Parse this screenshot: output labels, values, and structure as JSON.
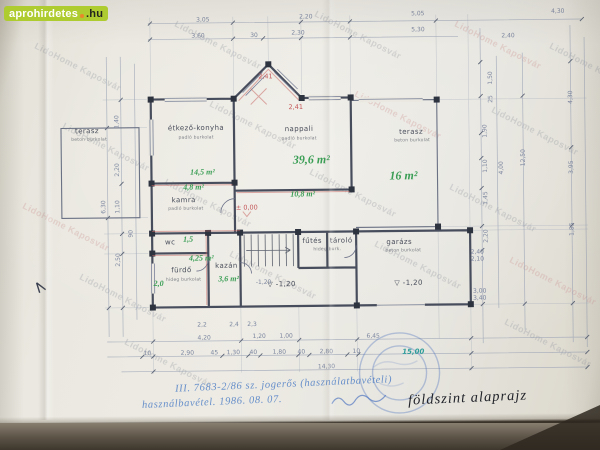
{
  "palette": {
    "logo_green": "#aecb2f",
    "logo_orange": "#e8882a",
    "pencil": "#4a4f5c",
    "green": "#3a9e55",
    "red": "#c4575a",
    "dim": "#7d87a0",
    "teal": "#2f9e9b",
    "wall": "#474d5c",
    "ink": "#22242b"
  },
  "logo": {
    "brand": "aprohirdetes",
    "tld": ".hu"
  },
  "watermark": {
    "text": "LidoHome Kaposvár",
    "tiles": [
      {
        "x": 30,
        "y": 62
      },
      {
        "x": 170,
        "y": 40
      },
      {
        "x": 310,
        "y": 30
      },
      {
        "x": 450,
        "y": 40,
        "pink": true
      },
      {
        "x": 545,
        "y": 62
      },
      {
        "x": 58,
        "y": 142
      },
      {
        "x": 205,
        "y": 120
      },
      {
        "x": 350,
        "y": 110,
        "pink": true
      },
      {
        "x": 487,
        "y": 126
      },
      {
        "x": 18,
        "y": 222,
        "pink": true
      },
      {
        "x": 160,
        "y": 198
      },
      {
        "x": 305,
        "y": 188
      },
      {
        "x": 445,
        "y": 203
      },
      {
        "x": 75,
        "y": 293
      },
      {
        "x": 225,
        "y": 270
      },
      {
        "x": 370,
        "y": 260
      },
      {
        "x": 505,
        "y": 276,
        "pink": true
      },
      {
        "x": 120,
        "y": 358
      },
      {
        "x": 500,
        "y": 338
      }
    ]
  },
  "notes": {
    "permit_line1": "III. 7683-2/86 sz. jogerős (használatbavételi)",
    "permit_line2": "használbavétel. 1986. 08. 07.",
    "title": "földszint alaprajz"
  },
  "plan": {
    "labels": [
      {
        "t": "terasz",
        "x": 88,
        "y": 129,
        "cls": "pencil",
        "name": "room-label-terasz-left"
      },
      {
        "t": "beton burkolat",
        "x": 90,
        "y": 138,
        "cls": "pencil tiny"
      },
      {
        "t": "étkező-konyha",
        "x": 197,
        "y": 127,
        "cls": "pencil",
        "name": "room-label-etkezo-konyha"
      },
      {
        "t": "padló burkolat",
        "x": 197,
        "y": 137,
        "cls": "pencil tiny"
      },
      {
        "t": "14,5 m²",
        "x": 203,
        "y": 171,
        "cls": "green",
        "name": "area-etkezo-konyha"
      },
      {
        "t": "nappali",
        "x": 300,
        "y": 129,
        "cls": "pencil",
        "name": "room-label-nappali"
      },
      {
        "t": "padló burkolat",
        "x": 300,
        "y": 139,
        "cls": "pencil tiny"
      },
      {
        "t": "39,6 m²",
        "x": 312,
        "y": 160,
        "cls": "green big",
        "name": "area-nappali"
      },
      {
        "t": "10,8 m²",
        "x": 303,
        "y": 194,
        "cls": "green",
        "name": "area-kozlekedo"
      },
      {
        "t": "terasz",
        "x": 412,
        "y": 133,
        "cls": "pencil",
        "name": "room-label-terasz-right"
      },
      {
        "t": "beton burkolat",
        "x": 413,
        "y": 142,
        "cls": "pencil tiny"
      },
      {
        "t": "16 m²",
        "x": 404,
        "y": 177,
        "cls": "green big",
        "name": "area-terasz"
      },
      {
        "t": "4,8 m²",
        "x": 194,
        "y": 186,
        "cls": "green",
        "name": "area-kamra"
      },
      {
        "t": "kamra",
        "x": 184,
        "y": 199,
        "cls": "pencil",
        "name": "room-label-kamra"
      },
      {
        "t": "padló burkolat",
        "x": 186,
        "y": 208,
        "cls": "pencil tiny"
      },
      {
        "t": "wc",
        "x": 170,
        "y": 241,
        "cls": "pencil",
        "name": "room-label-wc"
      },
      {
        "t": "1,5",
        "x": 188,
        "y": 238,
        "cls": "green",
        "name": "area-wc"
      },
      {
        "t": "4,25 m²",
        "x": 201,
        "y": 257,
        "cls": "green",
        "name": "area-furdo"
      },
      {
        "t": "fürdő",
        "x": 181,
        "y": 269,
        "cls": "pencil",
        "name": "room-label-furdo"
      },
      {
        "t": "hideg burkolat",
        "x": 183,
        "y": 279,
        "cls": "pencil tiny"
      },
      {
        "t": "2,0",
        "x": 158,
        "y": 282,
        "cls": "green"
      },
      {
        "t": "kazán",
        "x": 226,
        "y": 265,
        "cls": "pencil",
        "name": "room-label-kazan"
      },
      {
        "t": "3,6 m²",
        "x": 228,
        "y": 278,
        "cls": "green",
        "name": "area-kazan"
      },
      {
        "t": "fűtés",
        "x": 312,
        "y": 241,
        "cls": "pencil",
        "name": "room-label-futes"
      },
      {
        "t": "tároló",
        "x": 341,
        "y": 241,
        "cls": "pencil",
        "name": "room-label-tarolo"
      },
      {
        "t": "hideg burk.",
        "x": 327,
        "y": 250,
        "cls": "pencil tiny"
      },
      {
        "t": "garázs",
        "x": 399,
        "y": 243,
        "cls": "pencil",
        "name": "room-label-garazs"
      },
      {
        "t": "beton burkolat",
        "x": 403,
        "y": 252,
        "cls": "pencil tiny"
      },
      {
        "t": "▽ -1,20",
        "x": 281,
        "y": 284,
        "cls": "pencil",
        "name": "level-mark-stairs"
      },
      {
        "t": "▽ -1,20",
        "x": 408,
        "y": 284,
        "cls": "pencil",
        "name": "level-mark-garazs"
      },
      {
        "t": "± 0,00",
        "x": 247,
        "y": 207,
        "cls": "red",
        "name": "level-mark-zero"
      },
      {
        "t": "2,41",
        "x": 267,
        "y": 76,
        "cls": "red"
      },
      {
        "t": "2,41",
        "x": 297,
        "y": 107,
        "cls": "red"
      },
      {
        "t": "3,05",
        "x": 205,
        "y": 19,
        "cls": "dim"
      },
      {
        "t": "2,20",
        "x": 308,
        "y": 17,
        "cls": "dim"
      },
      {
        "t": "5,05",
        "x": 420,
        "y": 15,
        "cls": "dim"
      },
      {
        "t": "4,30",
        "x": 560,
        "y": 14,
        "cls": "dim"
      },
      {
        "t": "3,60",
        "x": 200,
        "y": 35,
        "cls": "dim"
      },
      {
        "t": "30",
        "x": 256,
        "y": 35,
        "cls": "dim"
      },
      {
        "t": "2,30",
        "x": 300,
        "y": 33,
        "cls": "dim"
      },
      {
        "t": "5,30",
        "x": 420,
        "y": 31,
        "cls": "dim"
      },
      {
        "t": "2,40",
        "x": 510,
        "y": 38,
        "cls": "dim"
      },
      {
        "t": "1,40",
        "x": 118,
        "y": 120,
        "cls": "dim",
        "r": -90
      },
      {
        "t": "2,20",
        "x": 118,
        "y": 168,
        "cls": "dim",
        "r": -90
      },
      {
        "t": "1,10",
        "x": 118,
        "y": 205,
        "cls": "dim",
        "r": -90
      },
      {
        "t": "2,50",
        "x": 118,
        "y": 258,
        "cls": "dim",
        "r": -90
      },
      {
        "t": "6,30",
        "x": 104,
        "y": 205,
        "cls": "dim",
        "r": -90
      },
      {
        "t": "90",
        "x": 131,
        "y": 232,
        "cls": "dim",
        "r": -90
      },
      {
        "t": "1,50",
        "x": 492,
        "y": 80,
        "cls": "dim",
        "r": -90
      },
      {
        "t": "25",
        "x": 492,
        "y": 101,
        "cls": "dim",
        "r": -90
      },
      {
        "t": "1,90",
        "x": 486,
        "y": 133,
        "cls": "dim",
        "r": -90
      },
      {
        "t": "1,10",
        "x": 486,
        "y": 168,
        "cls": "dim",
        "r": -90
      },
      {
        "t": "1,45",
        "x": 486,
        "y": 200,
        "cls": "dim",
        "r": -90
      },
      {
        "t": "4,00",
        "x": 502,
        "y": 170,
        "cls": "dim",
        "r": -90
      },
      {
        "t": "2,20",
        "x": 486,
        "y": 238,
        "cls": "dim",
        "r": -90
      },
      {
        "t": "12,50",
        "x": 524,
        "y": 160,
        "cls": "dim",
        "r": -90
      },
      {
        "t": "4,30",
        "x": 572,
        "y": 100,
        "cls": "dim",
        "r": -90
      },
      {
        "t": "3,95",
        "x": 572,
        "y": 170,
        "cls": "dim",
        "r": -90
      },
      {
        "t": "1,85",
        "x": 572,
        "y": 232,
        "cls": "dim",
        "r": -90
      },
      {
        "t": "2,40",
        "x": 477,
        "y": 254,
        "cls": "dim"
      },
      {
        "t": "2,10",
        "x": 477,
        "y": 261,
        "cls": "dim"
      },
      {
        "t": "3,00",
        "x": 479,
        "y": 293,
        "cls": "dim"
      },
      {
        "t": "3,40",
        "x": 479,
        "y": 300,
        "cls": "dim"
      },
      {
        "t": "2,2",
        "x": 201,
        "y": 324,
        "cls": "dim"
      },
      {
        "t": "2,4",
        "x": 233,
        "y": 324,
        "cls": "dim"
      },
      {
        "t": "2,3",
        "x": 251,
        "y": 324,
        "cls": "dim"
      },
      {
        "t": "4,20",
        "x": 203,
        "y": 337,
        "cls": "dim"
      },
      {
        "t": "1,20",
        "x": 258,
        "y": 336,
        "cls": "dim"
      },
      {
        "t": "1,00",
        "x": 285,
        "y": 336,
        "cls": "dim"
      },
      {
        "t": "6,45",
        "x": 372,
        "y": 337,
        "cls": "dim"
      },
      {
        "t": "10",
        "x": 146,
        "y": 352,
        "cls": "dim"
      },
      {
        "t": "2,90",
        "x": 186,
        "y": 352,
        "cls": "dim"
      },
      {
        "t": "45",
        "x": 213,
        "y": 352,
        "cls": "dim"
      },
      {
        "t": "1,30",
        "x": 232,
        "y": 352,
        "cls": "dim"
      },
      {
        "t": "40",
        "x": 252,
        "y": 352,
        "cls": "dim"
      },
      {
        "t": "1,80",
        "x": 278,
        "y": 352,
        "cls": "dim"
      },
      {
        "t": "40",
        "x": 300,
        "y": 352,
        "cls": "dim"
      },
      {
        "t": "2,80",
        "x": 325,
        "y": 352,
        "cls": "dim"
      },
      {
        "t": "10",
        "x": 355,
        "y": 352,
        "cls": "dim"
      },
      {
        "t": "15,00",
        "x": 412,
        "y": 353,
        "cls": "teal"
      },
      {
        "t": "14,30",
        "x": 325,
        "y": 367,
        "cls": "dim"
      },
      {
        "t": "-1,20",
        "x": 263,
        "y": 282,
        "cls": "dim"
      }
    ]
  }
}
